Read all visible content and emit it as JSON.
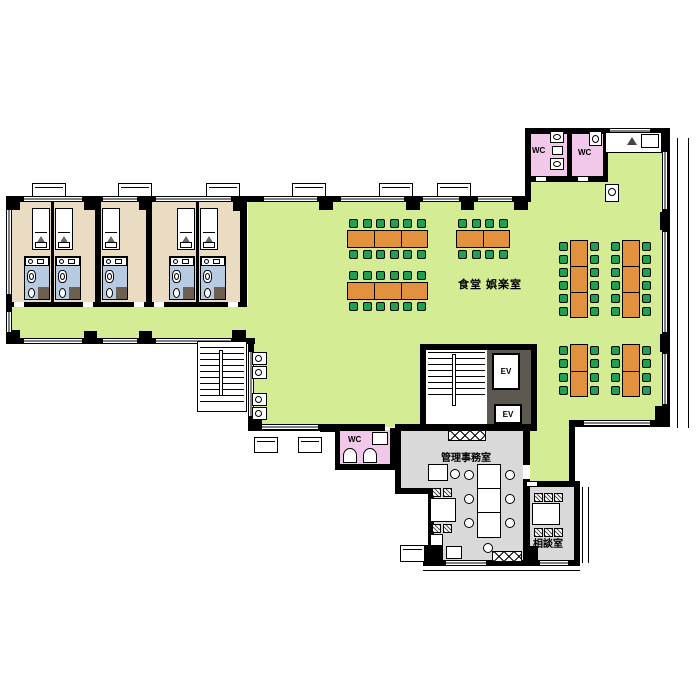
{
  "floor_plan": {
    "labels": {
      "dining_recreation_room": "食堂 娯楽室",
      "admin_office": "管理事務室",
      "consultation_room": "相談室",
      "toilet": "WC",
      "elevator": "EV"
    },
    "colors": {
      "floor_green": "#d4ec94",
      "bedroom_beige": "#eadcc2",
      "bathroom_blue": "#b6cbe2",
      "wc_pink": "#f2c8ea",
      "office_gray": "#d9d9d9",
      "elevator_shaft_gray": "#5d5950",
      "table_orange": "#e2913e",
      "chair_green": "#21a04e",
      "wall_black": "#000000",
      "fixture_dark": "#6b6052"
    },
    "bedrooms": [
      {
        "x": 12,
        "w": 39,
        "bed_side": "right",
        "door": "left"
      },
      {
        "x": 54,
        "w": 41,
        "bed_side": "left",
        "door": "right"
      },
      {
        "x": 101,
        "w": 45,
        "bed_side": "left",
        "door": "right"
      },
      {
        "x": 152,
        "w": 44,
        "bed_side": "right",
        "door": "left"
      },
      {
        "x": 199,
        "w": 41,
        "bed_side": "left",
        "door": "right"
      }
    ],
    "dining_tables": [
      {
        "x": 347,
        "y": 230,
        "w": 81,
        "h": 18,
        "orient": "h",
        "segments": 3,
        "seats_per_side": 6
      },
      {
        "x": 456,
        "y": 230,
        "w": 54,
        "h": 18,
        "orient": "h",
        "segments": 2,
        "seats_per_side": 4
      },
      {
        "x": 347,
        "y": 282,
        "w": 81,
        "h": 18,
        "orient": "h",
        "segments": 3,
        "seats_per_side": 6
      },
      {
        "x": 570,
        "y": 240,
        "w": 18,
        "h": 78,
        "orient": "v",
        "segments": 3,
        "seats_per_side": 6
      },
      {
        "x": 622,
        "y": 240,
        "w": 18,
        "h": 78,
        "orient": "v",
        "segments": 3,
        "seats_per_side": 6
      },
      {
        "x": 570,
        "y": 344,
        "w": 18,
        "h": 53,
        "orient": "v",
        "segments": 2,
        "seats_per_side": 4
      },
      {
        "x": 622,
        "y": 344,
        "w": 18,
        "h": 53,
        "orient": "v",
        "segments": 2,
        "seats_per_side": 4
      }
    ],
    "wash_basins": [
      {
        "x": 252,
        "y": 352
      },
      {
        "x": 252,
        "y": 366
      },
      {
        "x": 252,
        "y": 393
      },
      {
        "x": 252,
        "y": 407
      }
    ],
    "window_bays_top": [
      32,
      118,
      206,
      292,
      379,
      437
    ]
  }
}
